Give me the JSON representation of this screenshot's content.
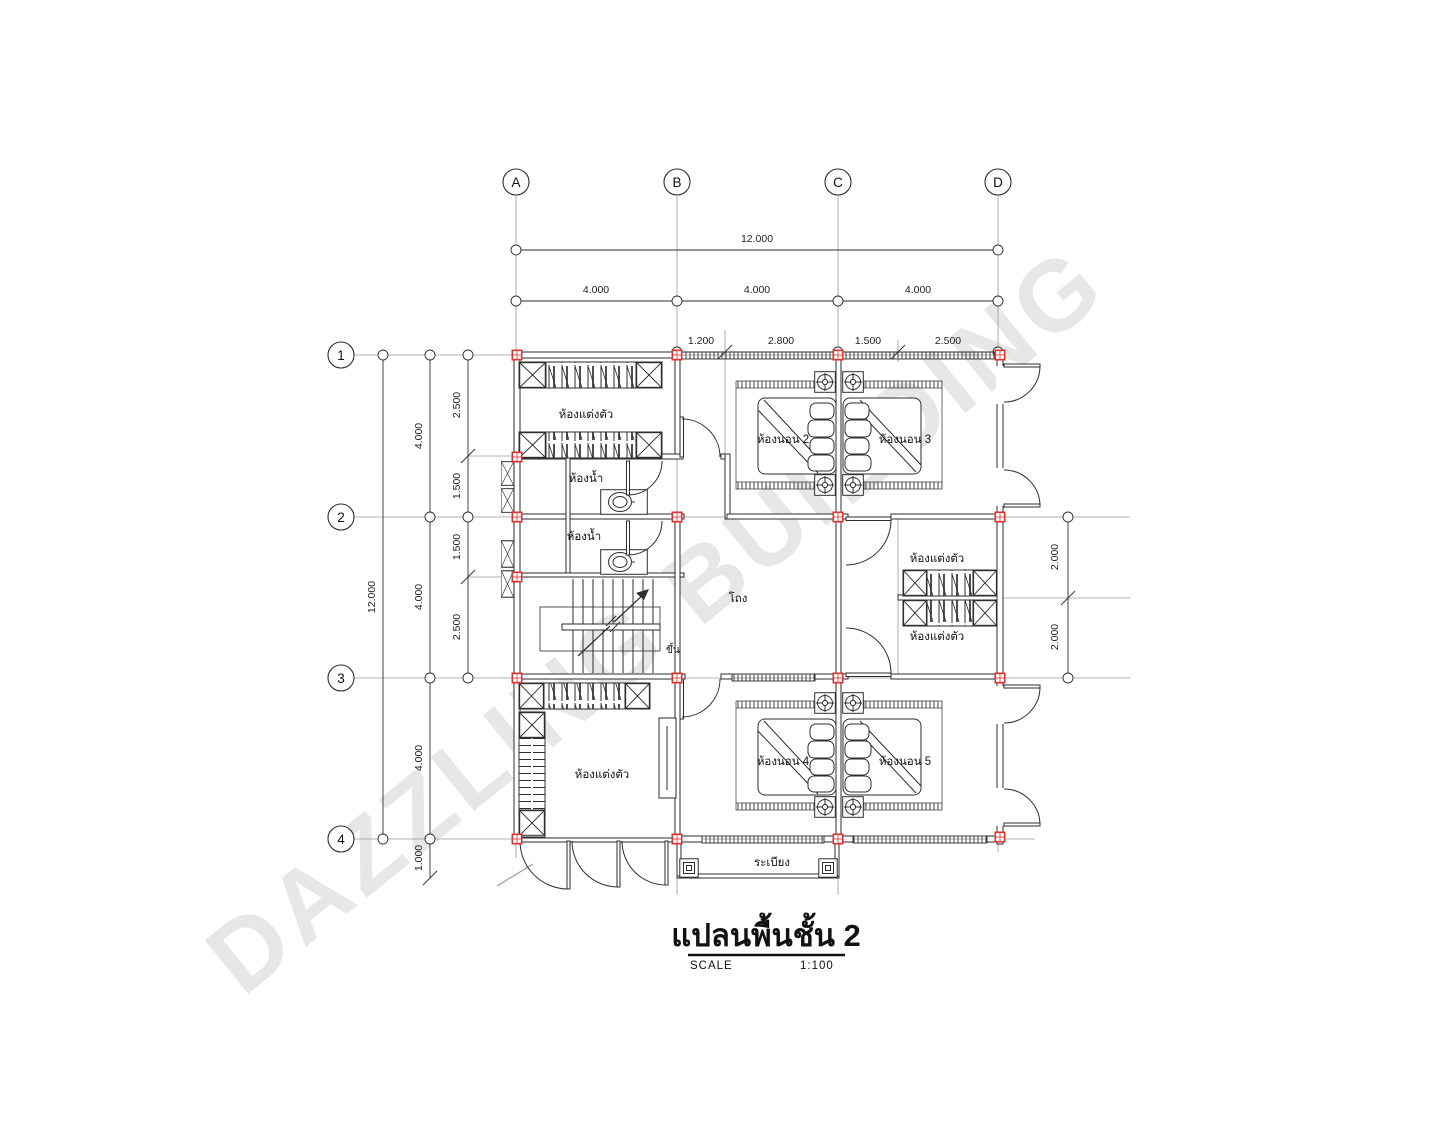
{
  "drawing_title": {
    "text": "แปลนพื้นชั้น 2",
    "scale_label": "SCALE",
    "scale_value": "1:100"
  },
  "watermark": {
    "text": "DAZZLING BUILDING"
  },
  "grid": {
    "cols": [
      "A",
      "B",
      "C",
      "D"
    ],
    "rows": [
      "1",
      "2",
      "3",
      "4"
    ]
  },
  "dims": {
    "top_total": "12.000",
    "top_spans": [
      "4.000",
      "4.000",
      "4.000"
    ],
    "top_subs": [
      "1.200",
      "2.800",
      "1.500",
      "2.500"
    ],
    "left_total": "12.000",
    "left_spans": [
      "4.000",
      "4.000",
      "4.000"
    ],
    "left_subs": [
      "2.500",
      "1.500",
      "1.500",
      "2.500"
    ],
    "left_balcony": "1.000",
    "right_subs": [
      "2.000",
      "2.000"
    ]
  },
  "rooms": {
    "dressing_top_left": "ห้องแต่งตัว",
    "bathroom_upper": "ห้องน้ำ",
    "bathroom_lower": "ห้องน้ำ",
    "bedroom2": "ห้องนอน 2",
    "bedroom3": "ห้องนอน 3",
    "hall": "โถง",
    "stair_up": "ขึ้น",
    "dressing_right_upper": "ห้องแต่งตัว",
    "dressing_right_lower": "ห้องแต่งตัว",
    "dressing_bottom_left": "ห้องแต่งตัว",
    "bedroom4": "ห้องนอน 4",
    "bedroom5": "ห้องนอน 5",
    "balcony": "ระเบียง"
  },
  "colors": {
    "line": "#2e2e2e",
    "grid_line": "#9a9a9a",
    "column_marker": "#e03131",
    "watermark_fill": "#e7e7e7",
    "watermark_stroke": "#cfcfcf"
  }
}
